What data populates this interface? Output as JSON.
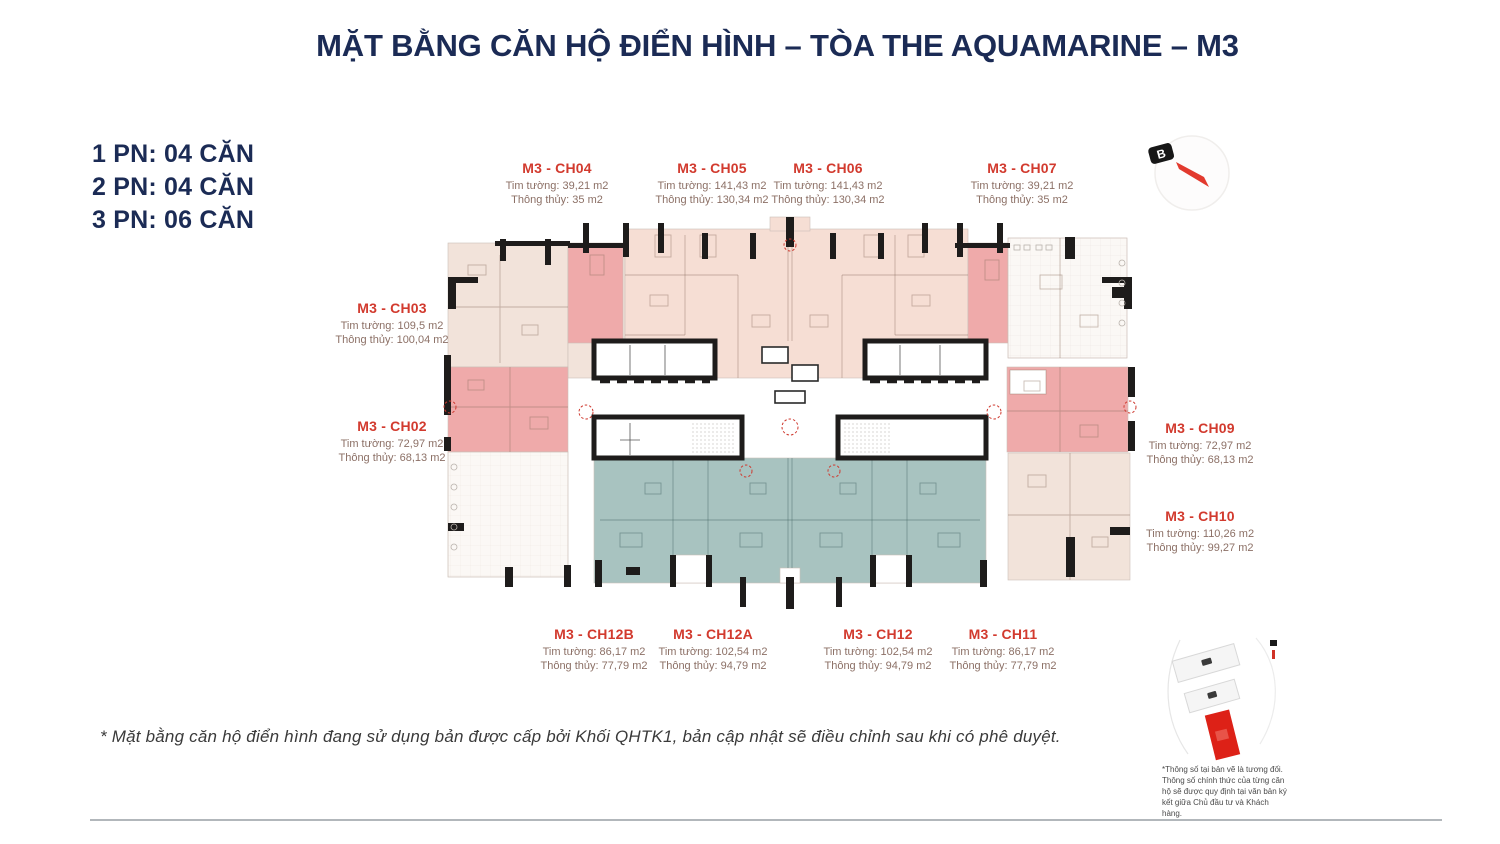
{
  "title": "MẶT BẰNG CĂN HỘ ĐIỂN HÌNH – TÒA THE AQUAMARINE – M3",
  "legend": {
    "items": [
      "1 PN: 04 CĂN",
      "2 PN: 04 CĂN",
      "3 PN: 06 CĂN"
    ]
  },
  "compass": {
    "north_label": "B"
  },
  "units": [
    {
      "id": "ch04",
      "label": "M3 - CH04",
      "line1": "Tim tường: 39,21 m2",
      "line2": "Thông thủy: 35 m2"
    },
    {
      "id": "ch05",
      "label": "M3 - CH05",
      "line1": "Tim tường: 141,43 m2",
      "line2": "Thông thủy: 130,34 m2"
    },
    {
      "id": "ch06",
      "label": "M3 - CH06",
      "line1": "Tim tường: 141,43 m2",
      "line2": "Thông thủy: 130,34 m2"
    },
    {
      "id": "ch07",
      "label": "M3 - CH07",
      "line1": "Tim tường: 39,21 m2",
      "line2": "Thông thủy: 35 m2"
    },
    {
      "id": "ch03",
      "label": "M3 - CH03",
      "line1": "Tim tường: 109,5 m2",
      "line2": "Thông thủy: 100,04 m2"
    },
    {
      "id": "ch02",
      "label": "M3 - CH02",
      "line1": "Tim tường: 72,97 m2",
      "line2": "Thông thủy: 68,13 m2"
    },
    {
      "id": "ch09",
      "label": "M3 - CH09",
      "line1": "Tim tường: 72,97 m2",
      "line2": "Thông thủy: 68,13 m2"
    },
    {
      "id": "ch10",
      "label": "M3 - CH10",
      "line1": "Tim tường: 110,26 m2",
      "line2": "Thông thủy: 99,27 m2"
    },
    {
      "id": "ch12b",
      "label": "M3 - CH12B",
      "line1": "Tim tường: 86,17 m2",
      "line2": "Thông thủy: 77,79 m2"
    },
    {
      "id": "ch12a",
      "label": "M3 - CH12A",
      "line1": "Tim tường: 102,54 m2",
      "line2": "Thông thủy: 94,79 m2"
    },
    {
      "id": "ch12",
      "label": "M3 - CH12",
      "line1": "Tim tường: 102,54 m2",
      "line2": "Thông thủy: 94,79 m2"
    },
    {
      "id": "ch11",
      "label": "M3 - CH11",
      "line1": "Tim tường: 86,17 m2",
      "line2": "Thông thủy: 77,79 m2"
    }
  ],
  "minimap": {
    "note": "*Thông số tại bản vẽ là tương đối. Thông số chính thức của từng căn hộ sẽ được quy định tại văn bản ký kết giữa Chủ đầu tư và Khách hàng."
  },
  "footnote": "* Mặt bằng căn hộ điển hình đang sử dụng bản được cấp bởi Khối QHTK1, bản cập nhật sẽ điều chỉnh sau khi có phê duyệt.",
  "colors": {
    "navy": "#1b2b55",
    "unit_red": "#d23a2e",
    "unit_sub_text": "#8c7066",
    "pink_light": "#f6ded4",
    "pink_accent": "#efaaaa",
    "beige": "#f2e3da",
    "teal": "#a8c3c0",
    "wall_black": "#1e1c1b",
    "map_red": "#dd2117"
  }
}
